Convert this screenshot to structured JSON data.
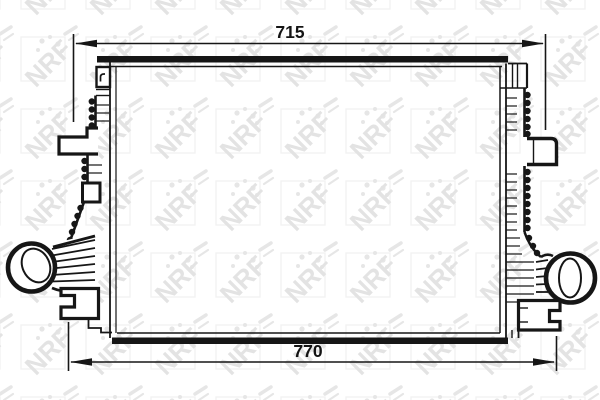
{
  "drawing": {
    "kind": "intercooler-radiator-technical-line-drawing",
    "dimensions": {
      "top": {
        "value": "715"
      },
      "bottom": {
        "value": "770"
      }
    },
    "watermark": {
      "text": "NRF"
    },
    "icons": {
      "dimension_arrowheads": "filled-triangle",
      "watermark_logo": "nrf-diagonal-logo"
    },
    "colors": {
      "line": "#161616",
      "background": "#ffffff",
      "watermark": "#e3e3e3",
      "watermark_frame": "#f1f1f1"
    }
  }
}
